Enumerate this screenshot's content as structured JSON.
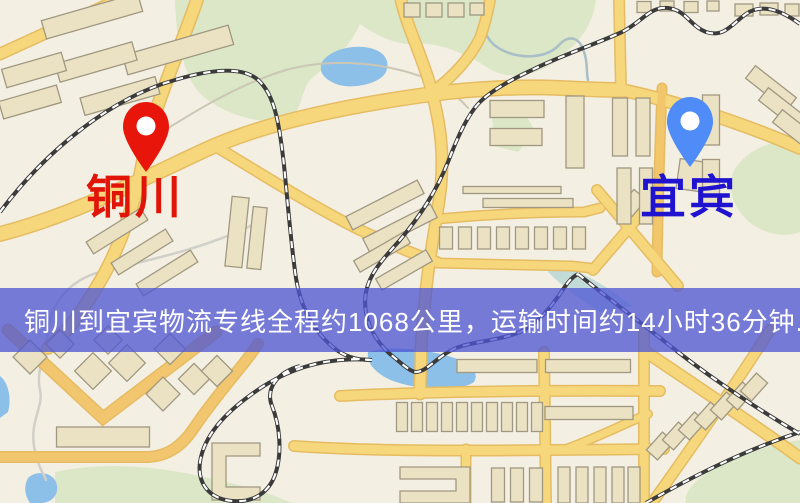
{
  "banner": {
    "text": "铜川到宜宾物流专线全程约1068公里，运输时间约14小时36分钟.",
    "bg": "rgba(78,85,212,0.76)",
    "text_color": "#ffffff",
    "top": 288,
    "height": 64
  },
  "markers": {
    "origin": {
      "name": "铜川",
      "pin_color": "#e8150b",
      "label_color": "#e11408",
      "pin_x": 123,
      "pin_y": 102,
      "label_x": 86,
      "label_y": 174
    },
    "dest": {
      "name": "宜宾",
      "pin_color": "#4f8cf7",
      "label_color": "#2013d0",
      "pin_x": 667,
      "pin_y": 97,
      "label_x": 640,
      "label_y": 174
    }
  },
  "map": {
    "colors": {
      "land": "#f4efe3",
      "green": "#dbe7c6",
      "water": "#8cc0e8",
      "road": "#f7d77c",
      "roadCasing": "#e5bc62",
      "building": "#ebe2c4",
      "buildingStroke": "#a09880",
      "railDark": "#3b3b3b",
      "railLight": "#ffffff"
    },
    "greens": [
      {
        "d": "M175,0 L596,0 C592,30 575,45 560,58 C540,75 510,82 488,68 C470,56 440,42 418,44 C400,46 380,38 360,24 C348,50 330,64 312,78 C300,90 304,108 290,118 C268,126 232,118 205,98 C186,83 176,45 175,0 Z"
      },
      {
        "d": "M800,138 C770,140 740,152 732,176 C726,196 740,220 762,230 C776,236 790,236 800,232 Z"
      },
      {
        "d": "M492,118 L524,112 L536,132 L518,152 L494,146 Z"
      },
      {
        "d": "M55,472 C100,462 150,466 190,474 C230,482 268,492 292,503 L55,503 Z"
      },
      {
        "d": "M800,440 C760,446 720,462 700,478 C688,488 684,496 686,503 L800,503 Z"
      },
      {
        "d": "M552,262 C580,270 610,288 632,306 L600,312 C580,300 560,284 548,272 Z",
        "c": "#c2dbd8"
      }
    ],
    "waters": [
      {
        "d": "M322,62 C330,50 352,44 370,48 C386,52 390,62 386,72 C380,84 352,90 336,84 C324,79 318,72 322,62 Z"
      },
      {
        "d": "M28,478 C36,470 52,472 56,482 C60,492 54,502 42,503 L30,503 C24,494 24,486 28,478 Z"
      },
      {
        "d": "M0,376 C8,382 12,398 8,412 L0,418 Z"
      },
      {
        "d": "M368,352 C390,346 420,348 448,356 C470,362 480,372 474,382 C460,392 420,390 396,382 C378,376 366,364 368,352 Z"
      }
    ],
    "trails": [
      {
        "d": "M162,132 C200,108 240,84 286,70 C330,58 380,62 420,76 C440,83 456,94 468,108",
        "w": 2,
        "c": "#ccc6b4"
      },
      {
        "d": "M258,222 C210,248 140,262 100,272 C70,280 52,302 48,330 C44,360 36,372 40,390 C44,406 30,420 34,446 C38,468 44,474 46,480",
        "w": 2.5,
        "c": "#d0d0c8"
      },
      {
        "d": "M488,0 C480,20 482,40 502,50 C522,60 548,58 560,44 C570,34 580,38 584,52 C588,62 586,72 588,80",
        "w": 2.5,
        "c": "#a8bfc8"
      }
    ],
    "roads": [
      {
        "d": "M0,54 L118,0",
        "w": 10
      },
      {
        "d": "M197,0 C178,55 152,110 143,160 C136,200 120,250 96,288 C84,308 70,330 48,348",
        "w": 11
      },
      {
        "d": "M0,234 C70,216 130,185 205,150 C270,120 360,104 432,94 C470,89 520,86 560,88 C585,89 605,90 622,90",
        "w": 13
      },
      {
        "d": "M432,92 C452,78 470,58 480,38 C486,22 488,10 490,0",
        "w": 9
      },
      {
        "d": "M619,0 L621,90",
        "w": 9
      },
      {
        "d": "M622,90 C670,100 740,122 800,148",
        "w": 11
      },
      {
        "d": "M401,0 C408,30 424,60 432,92 C440,124 444,150 441,185 C438,215 430,250 426,290 C423,320 421,336 421,352 C421,370 420,382 420,394",
        "w": 10
      },
      {
        "d": "M437,219 C490,214 545,212 584,212 L600,208",
        "w": 8
      },
      {
        "d": "M437,263 C490,264 540,265 572,266 L590,268",
        "w": 8
      },
      {
        "d": "M215,146 C255,170 310,205 360,230 C390,244 415,255 437,262",
        "w": 9
      },
      {
        "d": "M662,88 C660,140 658,200 657,272",
        "w": 8,
        "c": "#f2c66a"
      },
      {
        "d": "M593,270 L658,194",
        "w": 9
      },
      {
        "d": "M597,190 L678,286",
        "w": 9
      },
      {
        "d": "M8,330 L103,418 L216,332",
        "w": 10,
        "c": "#f2c66e"
      },
      {
        "d": "M0,457 L148,457 C168,456 182,446 194,428 C206,410 222,390 240,368 C248,358 254,350 258,344",
        "w": 9,
        "c": "#f2c66e"
      },
      {
        "d": "M340,396 C420,392 520,390 660,391",
        "w": 9
      },
      {
        "d": "M294,446 C380,452 480,451 664,449",
        "w": 9
      },
      {
        "d": "M544,352 L546,503",
        "w": 9
      },
      {
        "d": "M644,330 L644,503",
        "w": 9
      },
      {
        "d": "M466,449 L466,503",
        "w": 8
      },
      {
        "d": "M646,352 C695,385 755,425 800,458",
        "w": 10
      },
      {
        "d": "M770,330 C735,385 690,450 652,503",
        "w": 9
      },
      {
        "d": "M566,449 C596,438 624,424 648,414",
        "w": 7
      }
    ],
    "buildings": [
      [
        92,
        16,
        100,
        19,
        -16
      ],
      [
        178,
        50,
        110,
        20,
        -16
      ],
      [
        96,
        62,
        80,
        19,
        -16
      ],
      [
        34,
        70,
        62,
        19,
        -16
      ],
      [
        30,
        102,
        60,
        18,
        -16
      ],
      [
        120,
        96,
        78,
        18,
        -16
      ],
      [
        117,
        231,
        64,
        14,
        -32
      ],
      [
        142,
        252,
        64,
        14,
        -32
      ],
      [
        167,
        273,
        64,
        14,
        -32
      ],
      [
        237,
        232,
        17,
        70,
        6
      ],
      [
        257,
        238,
        14,
        62,
        6
      ],
      [
        385,
        205,
        80,
        15,
        -27
      ],
      [
        400,
        228,
        76,
        15,
        -27
      ],
      [
        382,
        252,
        58,
        13,
        -30
      ],
      [
        404,
        270,
        58,
        13,
        -30
      ],
      [
        412,
        10,
        16,
        14,
        0
      ],
      [
        434,
        10,
        16,
        14,
        0
      ],
      [
        456,
        10,
        16,
        14,
        0
      ],
      [
        477,
        9,
        14,
        12,
        0
      ],
      [
        644,
        7,
        14,
        11,
        0
      ],
      [
        667,
        6,
        14,
        10,
        0
      ],
      [
        691,
        7,
        14,
        11,
        0
      ],
      [
        713,
        6,
        12,
        10,
        0
      ],
      [
        744,
        10,
        18,
        12,
        0
      ],
      [
        769,
        9,
        18,
        12,
        0
      ],
      [
        792,
        10,
        14,
        12,
        0
      ],
      [
        517,
        109,
        54,
        17,
        0
      ],
      [
        516,
        137,
        52,
        17,
        0
      ],
      [
        575,
        132,
        18,
        72,
        0
      ],
      [
        512,
        190,
        98,
        7,
        0
      ],
      [
        528,
        203,
        90,
        9,
        0
      ],
      [
        446,
        238,
        13,
        22,
        0
      ],
      [
        465,
        238,
        13,
        22,
        0
      ],
      [
        484,
        238,
        13,
        22,
        0
      ],
      [
        503,
        238,
        13,
        22,
        0
      ],
      [
        522,
        238,
        13,
        22,
        0
      ],
      [
        541,
        238,
        13,
        22,
        0
      ],
      [
        560,
        238,
        13,
        22,
        0
      ],
      [
        579,
        238,
        13,
        22,
        0
      ],
      [
        633,
        203,
        16,
        22,
        40
      ],
      [
        620,
        127,
        15,
        58,
        0
      ],
      [
        643,
        127,
        14,
        58,
        0
      ],
      [
        696,
        176,
        36,
        30,
        8
      ],
      [
        624,
        196,
        14,
        56,
        0
      ],
      [
        646,
        196,
        13,
        56,
        0
      ],
      [
        711,
        120,
        17,
        50,
        0
      ],
      [
        711,
        182,
        17,
        45,
        0
      ],
      [
        771,
        88,
        52,
        16,
        38
      ],
      [
        784,
        110,
        52,
        16,
        38
      ],
      [
        798,
        132,
        52,
        16,
        38
      ],
      [
        60,
        344,
        20,
        20,
        45
      ],
      [
        108,
        340,
        20,
        20,
        45
      ],
      [
        30,
        357,
        24,
        24,
        45
      ],
      [
        93,
        371,
        26,
        26,
        45
      ],
      [
        127,
        363,
        26,
        26,
        45
      ],
      [
        170,
        349,
        22,
        22,
        45
      ],
      [
        163,
        394,
        24,
        24,
        45
      ],
      [
        194,
        379,
        22,
        22,
        45
      ],
      [
        217,
        371,
        22,
        22,
        45
      ],
      [
        103,
        437,
        93,
        20,
        0
      ],
      [
        402,
        417,
        11,
        29,
        0
      ],
      [
        417,
        417,
        11,
        29,
        0
      ],
      [
        432,
        417,
        11,
        29,
        0
      ],
      [
        447,
        417,
        11,
        29,
        0
      ],
      [
        462,
        417,
        11,
        29,
        0
      ],
      [
        477,
        417,
        11,
        29,
        0
      ],
      [
        492,
        417,
        11,
        29,
        0
      ],
      [
        507,
        417,
        11,
        29,
        0
      ],
      [
        522,
        417,
        11,
        29,
        0
      ],
      [
        537,
        417,
        11,
        29,
        0
      ],
      [
        589,
        413,
        88,
        13,
        0
      ],
      [
        498,
        485,
        13,
        34,
        0
      ],
      [
        517,
        485,
        13,
        34,
        0
      ],
      [
        536,
        485,
        13,
        34,
        0
      ],
      [
        564,
        485,
        12,
        36,
        0
      ],
      [
        582,
        485,
        12,
        36,
        0
      ],
      [
        600,
        485,
        12,
        36,
        0
      ],
      [
        618,
        485,
        12,
        36,
        0
      ],
      [
        634,
        485,
        12,
        36,
        0
      ],
      [
        660,
        446,
        15,
        24,
        42
      ],
      [
        676,
        436,
        15,
        24,
        42
      ],
      [
        692,
        426,
        15,
        24,
        42
      ],
      [
        708,
        416,
        15,
        24,
        42
      ],
      [
        724,
        406,
        15,
        24,
        42
      ],
      [
        740,
        396,
        15,
        24,
        42
      ],
      [
        754,
        387,
        15,
        24,
        42
      ],
      [
        497,
        366,
        80,
        13,
        0
      ],
      [
        588,
        366,
        85,
        13,
        0
      ]
    ],
    "building_paths": [
      {
        "d": "M212,443 h48 v13 h-34 v31 h34 v13 h-48 Z"
      },
      {
        "d": "M400,467 h70 v36 h-70 v-12 h56 v-12 h-56 Z"
      }
    ],
    "railways": [
      {
        "d": "M0,212 C45,152 110,98 175,80 C215,68 248,66 262,84 C276,100 280,130 284,165 C288,205 291,245 296,278 C300,305 312,330 334,348 C344,356 356,360 370,360"
      },
      {
        "d": "M800,24 C778,8 760,4 746,14 C732,24 724,38 706,32 C690,26 686,10 668,8 C650,6 642,22 622,32 C596,44 560,56 532,70 C506,82 490,92 480,102 C468,114 458,136 448,162 C436,192 420,216 400,240 C384,258 370,272 366,292 C362,315 372,338 390,354 C400,362 410,372 416,372 C428,372 440,352 462,346 C480,341 500,340 520,332 C538,324 552,306 564,288 C570,279 574,276 578,274"
      },
      {
        "d": "M372,360 C320,356 282,372 252,394 C224,414 204,436 200,462 C197,484 210,499 232,501 C254,503 270,492 276,472 C282,452 280,426 272,406 C265,388 278,372 300,366"
      },
      {
        "d": "M578,274 C600,292 640,322 678,352 C714,380 762,412 800,434"
      },
      {
        "d": "M646,503 C690,478 740,452 800,432"
      }
    ]
  }
}
